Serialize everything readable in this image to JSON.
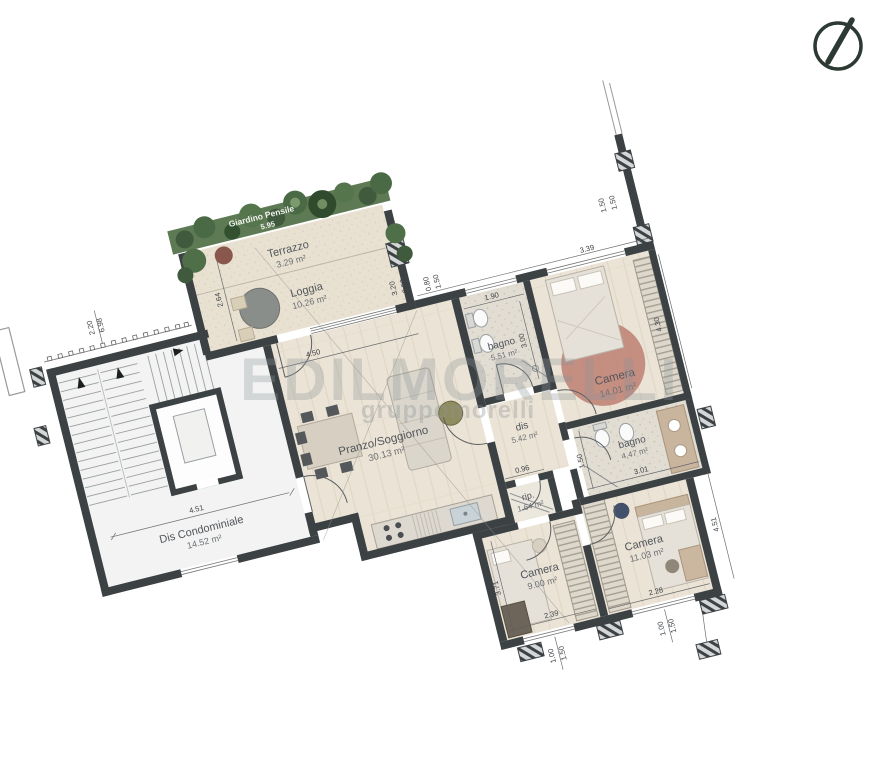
{
  "plan": {
    "watermark": {
      "line1": "EDILMORELLI",
      "line2": "gruppomorelli"
    },
    "rooms": {
      "giardino": {
        "name": "Giardino Pensile",
        "dim": "5.95"
      },
      "terrazzo": {
        "name": "Terrazzo",
        "area": "3.29 m²"
      },
      "loggia": {
        "name": "Loggia",
        "area": "10.26 m²"
      },
      "pranzo": {
        "name": "Pranzo/Soggiorno",
        "area": "30.13 m²"
      },
      "dis_condominiale": {
        "name": "Dis Condominiale",
        "area": "14.52 m²"
      },
      "bagno1": {
        "name": "bagno",
        "area": "5.51 m²"
      },
      "camera1": {
        "name": "Camera",
        "area": "14.01 m²"
      },
      "dis": {
        "name": "dis",
        "area": "5.42 m²"
      },
      "bagno2": {
        "name": "bagno",
        "area": "4.47 m²"
      },
      "rip": {
        "name": "rip.",
        "area": "1.64 m²"
      },
      "camera2": {
        "name": "Camera",
        "area": "9.00 m²"
      },
      "camera3": {
        "name": "Camera",
        "area": "11.03 m²"
      }
    },
    "dimensions": {
      "left_a": "2.20",
      "left_b": "6.98",
      "terrazzo_depth": "2.64",
      "loggia_window_w": "3.20",
      "loggia_window_h": "2.50",
      "living_top": "4.50",
      "hall_width": "4.51",
      "wing_top_a": "0.80",
      "wing_top_b": "1.50",
      "stub_a": "1.50",
      "stub_b": "1.50",
      "bagno1_w": "1.90",
      "bagno1_h": "3.00",
      "camera1_w": "3.39",
      "camera1_h": "4.30",
      "bagno2_h": "1.50",
      "bagno2_w": "3.01",
      "rip_w": "0.96",
      "camera2_h": "3.71",
      "camera2_w": "2.39",
      "camera3_w": "2.28",
      "camera3_h": "4.51",
      "win1_a": "1.00",
      "win1_b": "1.50",
      "win2_a": "1.00",
      "win2_b": "1.50"
    },
    "colors": {
      "wall": "#3c4144",
      "garden_green": "#5d7a54",
      "rug_pink": "#c08478",
      "compass": "#2c3a33"
    }
  }
}
